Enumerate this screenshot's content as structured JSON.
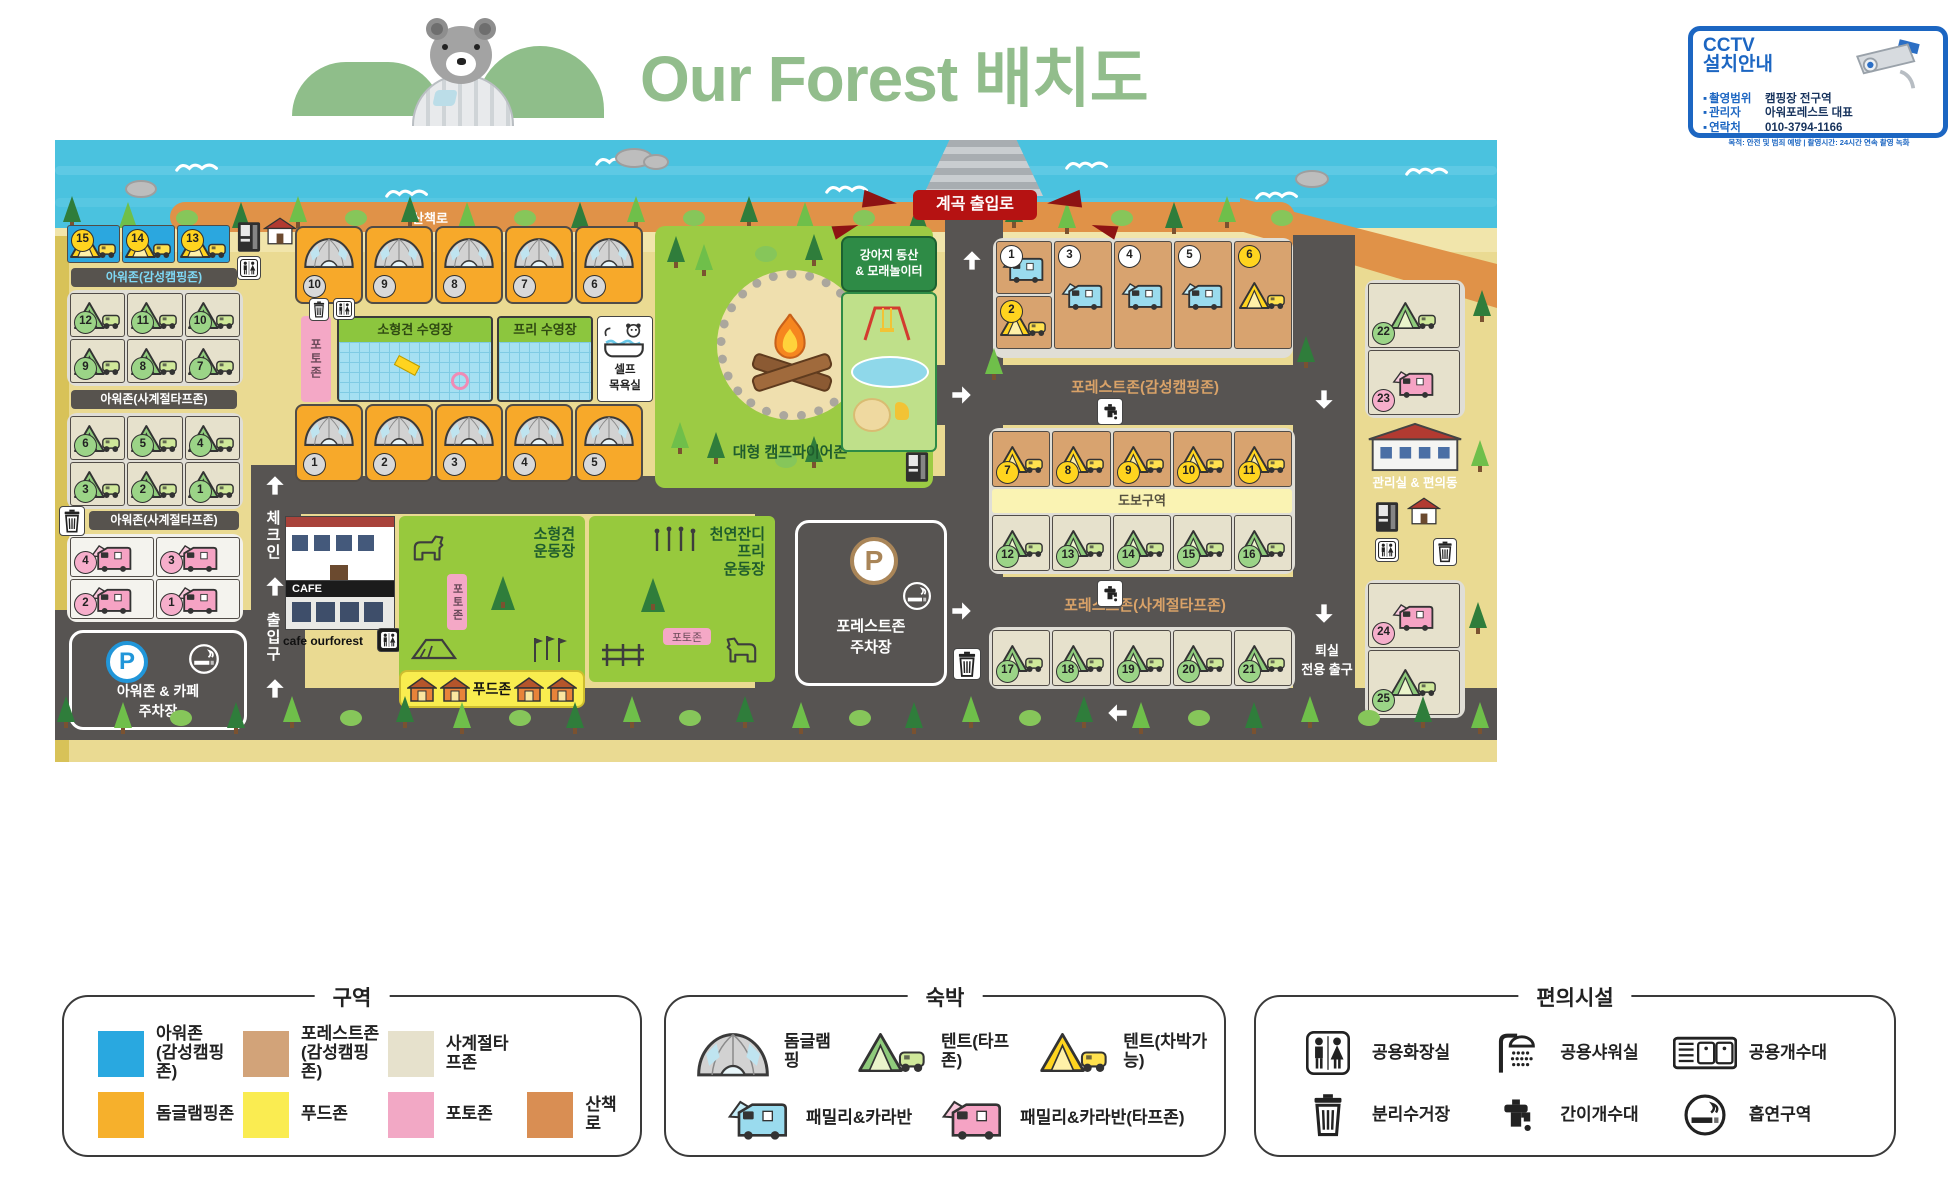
{
  "header": {
    "title": "Our Forest 배치도",
    "cctv": {
      "line1": "CCTV",
      "line2": "설치안내",
      "rows": [
        {
          "label": "촬영범위",
          "value": "캠핑장 전구역"
        },
        {
          "label": "관리자",
          "value": "아워포레스트 대표"
        },
        {
          "label": "연락처",
          "value": "010-3794-1166"
        }
      ],
      "footnote": "목적: 안전 및 범죄 예방 | 촬영시간: 24시간 연속 촬영 녹화"
    }
  },
  "map": {
    "labels": {
      "walkway": "산책로",
      "valley_gate": "계곡 출입로",
      "puppy_hill": "강아지 동산\n& 모래놀이터",
      "small_dog_pool": "소형견 수영장",
      "free_pool": "프리 수영장",
      "self_bath": "셀프\n목욕실",
      "campfire_zone": "대형 캠프파이어존",
      "our_zone_glamping": "아워존(감성캠핑존)",
      "our_zone_tarp_1": "아워존(사계절타프존)",
      "our_zone_tarp_2": "아워존(사계절타프존)",
      "our_parking": "아워존 & 카페\n주차장",
      "check_in": "체크인",
      "entrance": "출입구",
      "cafe_sign": "CAFE",
      "cafe_name": "cafe ourforest",
      "small_dog_field": "소형견\n운동장",
      "free_field": "천연잔디\n프리\n운동장",
      "photo_zone_1": "포토존",
      "photo_zone_2": "포토존",
      "photo_zone_3": "포토존",
      "food_zone": "푸드존",
      "forest_parking": "포레스트존\n주차장",
      "forest_zone_glamping": "포레스트존(감성캠핑존)",
      "walk_only": "도보구역",
      "forest_zone_tarp": "포레스트존(사계절타프존)",
      "admin_building": "관리실 & 편의동",
      "exit_only": "퇴실\n전용 출구",
      "parking_letter": "P"
    },
    "site_groups": {
      "our_glamping": {
        "sites": [
          {
            "n": 15,
            "t": "tent-car-yellow"
          },
          {
            "n": 14,
            "t": "tent-car-yellow"
          },
          {
            "n": 13,
            "t": "tent-car-yellow"
          }
        ]
      },
      "our_tarp_a": {
        "sites": [
          {
            "n": 12,
            "t": "tent-car-green"
          },
          {
            "n": 11,
            "t": "tent-car-green"
          },
          {
            "n": 10,
            "t": "tent-car-green"
          },
          {
            "n": 9,
            "t": "tent-car-green"
          },
          {
            "n": 8,
            "t": "tent-car-green"
          },
          {
            "n": 7,
            "t": "tent-car-green"
          }
        ]
      },
      "our_tarp_b": {
        "sites": [
          {
            "n": 6,
            "t": "tent-car-green"
          },
          {
            "n": 5,
            "t": "tent-car-green"
          },
          {
            "n": 4,
            "t": "tent-car-green"
          },
          {
            "n": 3,
            "t": "tent-car-green"
          },
          {
            "n": 2,
            "t": "tent-car-green"
          },
          {
            "n": 1,
            "t": "tent-car-green"
          }
        ]
      },
      "our_family": {
        "sites": [
          {
            "n": 4,
            "t": "caravan-pink"
          },
          {
            "n": 3,
            "t": "caravan-pink"
          },
          {
            "n": 2,
            "t": "caravan-pink"
          },
          {
            "n": 1,
            "t": "caravan-pink"
          }
        ]
      },
      "domes_top": {
        "sites": [
          {
            "n": 10,
            "t": "dome"
          },
          {
            "n": 9,
            "t": "dome"
          },
          {
            "n": 8,
            "t": "dome"
          },
          {
            "n": 7,
            "t": "dome"
          },
          {
            "n": 6,
            "t": "dome"
          }
        ]
      },
      "domes_bottom": {
        "sites": [
          {
            "n": 1,
            "t": "dome"
          },
          {
            "n": 2,
            "t": "dome"
          },
          {
            "n": 3,
            "t": "dome"
          },
          {
            "n": 4,
            "t": "dome"
          },
          {
            "n": 5,
            "t": "dome"
          }
        ]
      },
      "forest_caravans_stack": {
        "sites": [
          {
            "n": 1,
            "t": "caravan-blue"
          },
          {
            "n": 2,
            "t": "tent-car-yellow"
          }
        ]
      },
      "forest_caravans_tall": {
        "sites": [
          {
            "n": 3,
            "t": "caravan-blue"
          },
          {
            "n": 4,
            "t": "caravan-blue"
          },
          {
            "n": 5,
            "t": "caravan-blue"
          },
          {
            "n": 6,
            "t": "tent-car-yellow"
          }
        ]
      },
      "forest_glamping_row": {
        "sites": [
          {
            "n": 7,
            "t": "tent-car-yellow"
          },
          {
            "n": 8,
            "t": "tent-car-yellow"
          },
          {
            "n": 9,
            "t": "tent-car-yellow"
          },
          {
            "n": 10,
            "t": "tent-car-yellow"
          },
          {
            "n": 11,
            "t": "tent-car-yellow"
          }
        ]
      },
      "forest_tarp_row1": {
        "sites": [
          {
            "n": 12,
            "t": "tent-car-green"
          },
          {
            "n": 13,
            "t": "tent-car-green"
          },
          {
            "n": 14,
            "t": "tent-car-green"
          },
          {
            "n": 15,
            "t": "tent-car-green"
          },
          {
            "n": 16,
            "t": "tent-car-green"
          }
        ]
      },
      "forest_tarp_row2": {
        "sites": [
          {
            "n": 17,
            "t": "tent-car-green"
          },
          {
            "n": 18,
            "t": "tent-car-green"
          },
          {
            "n": 19,
            "t": "tent-car-green"
          },
          {
            "n": 20,
            "t": "tent-car-green"
          },
          {
            "n": 21,
            "t": "tent-car-green"
          }
        ]
      },
      "east_top": {
        "sites": [
          {
            "n": 22,
            "t": "tent-car-green"
          },
          {
            "n": 23,
            "t": "caravan-pink"
          }
        ]
      },
      "east_bottom": {
        "sites": [
          {
            "n": 24,
            "t": "caravan-pink"
          },
          {
            "n": 25,
            "t": "tent-car-green"
          }
        ]
      }
    }
  },
  "legend": {
    "zones": {
      "title": "구역",
      "items": [
        {
          "label": "아워존\n(감성캠핑존)",
          "color": "#29A8E0"
        },
        {
          "label": "포레스트존\n(감성캠핑존)",
          "color": "#D2A379"
        },
        {
          "label": "사계절타프존",
          "color": "#E6E1CC"
        },
        {
          "label": "돔글램핑존",
          "color": "#F6B02C"
        },
        {
          "label": "푸드존",
          "color": "#FAEC51"
        },
        {
          "label": "포토존",
          "color": "#F2A8C5"
        },
        {
          "label": "산책로",
          "color": "#D98E53"
        }
      ]
    },
    "lodging": {
      "title": "숙박",
      "items": [
        {
          "icon": "dome",
          "label": "돔글램핑"
        },
        {
          "icon": "tent-car-green",
          "label": "텐트(타프존)"
        },
        {
          "icon": "tent-car-yellow",
          "label": "텐트(차박가능)"
        },
        {
          "icon": "caravan-blue",
          "label": "패밀리&카라반"
        },
        {
          "icon": "caravan-pink",
          "label": "패밀리&카라반(타프존)"
        }
      ]
    },
    "facilities": {
      "title": "편의시설",
      "items": [
        {
          "icon": "restroom",
          "label": "공용화장실"
        },
        {
          "icon": "shower",
          "label": "공용샤워실"
        },
        {
          "icon": "sink",
          "label": "공용개수대"
        },
        {
          "icon": "trash",
          "label": "분리수거장"
        },
        {
          "icon": "faucet",
          "label": "간이개수대"
        },
        {
          "icon": "smoking",
          "label": "흡연구역"
        }
      ]
    }
  }
}
